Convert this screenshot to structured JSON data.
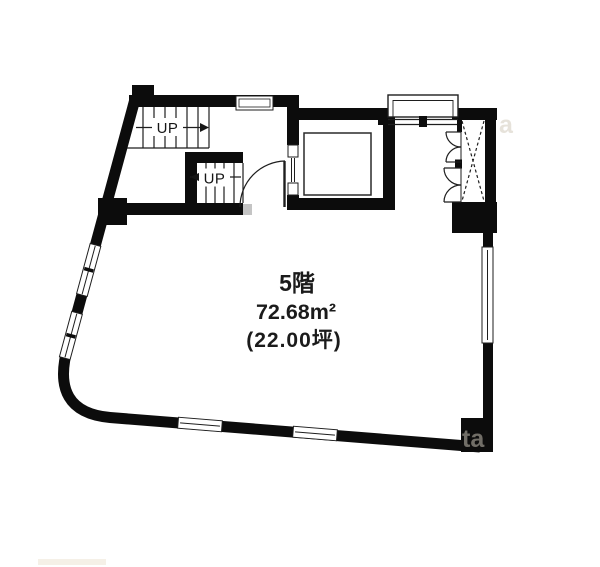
{
  "plan": {
    "floor_label": "5階",
    "area_sqm": "72.68m²",
    "area_tsubo": "(22.00坪)",
    "stairs": {
      "upper_up_label": "UP",
      "lower_up_label": "UP"
    },
    "colors": {
      "wall": "#0c0c0c",
      "thin_line": "#1e1e1e",
      "background": "#ffffff",
      "watermark": "#d6cfc2"
    },
    "watermark": {
      "right_text": "a",
      "corner_text": "ta"
    }
  }
}
